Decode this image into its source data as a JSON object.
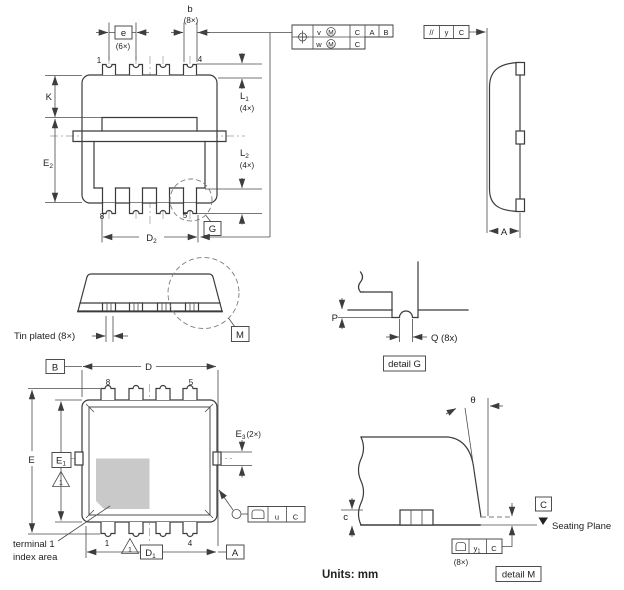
{
  "colors": {
    "line": "#3b3b3b",
    "dim": "#4a4a4a",
    "centerline": "#9a9a9a",
    "pad_shade": "#c9c9c9",
    "background": "#ffffff"
  },
  "units_label": "Units: mm",
  "top_view": {
    "dim_b": {
      "label": "b",
      "count": "(8×)"
    },
    "dim_e": {
      "label": "e",
      "count": "(6×)"
    },
    "pin_1": "1",
    "pin_4": "4",
    "pin_8": "8",
    "pin_5": "5",
    "dim_k": "K",
    "dim_e2": {
      "label": "E",
      "sub": "2"
    },
    "dim_l1": {
      "label": "L",
      "sub": "1",
      "count": "(4×)"
    },
    "dim_l2": {
      "label": "L",
      "sub": "2",
      "count": "(4×)"
    },
    "dim_d2": {
      "label": "D",
      "sub": "2"
    },
    "detail_ref_g": "G"
  },
  "tolerance_frames": {
    "position": {
      "tol_1": "v",
      "tol_2": "w",
      "modifier": "M",
      "datum_primary": "C",
      "datum_secondary": "A",
      "datum_tertiary": "B",
      "row2_datum": "C"
    },
    "parallelism": {
      "symbol": "//",
      "tolerance": "y",
      "datum": "C"
    },
    "coplanarity_u": {
      "tolerance": "u",
      "datum": "C"
    },
    "coplanarity_y1": {
      "tolerance": "y",
      "tolerance_sub": "1",
      "datum": "C",
      "count": "(8×)"
    }
  },
  "side_view": {
    "dim_a": "A"
  },
  "front_view": {
    "tin_plated_label": "Tin plated (8×)",
    "detail_ref_m": "M"
  },
  "detail_g": {
    "dim_p": "P",
    "dim_q": "Q (8x)",
    "caption": "detail G"
  },
  "bottom_view": {
    "datum_b": "B",
    "datum_a": "A",
    "dim_d": "D",
    "dim_d1": {
      "label": "D",
      "sub": "1"
    },
    "dim_e": "E",
    "dim_e1": {
      "label": "E",
      "sub": "1"
    },
    "dim_e3": {
      "label": "E",
      "sub": "3",
      "count": "(2×)"
    },
    "pin_8": "8",
    "pin_5": "5",
    "pin_1": "1",
    "pin_4": "4",
    "note_1": "1",
    "terminal_note": {
      "line1": "terminal 1",
      "line2": "index area"
    }
  },
  "detail_m": {
    "angle_theta": "θ",
    "dim_c": "c",
    "datum_c": "C",
    "seating_plane_label": "Seating Plane",
    "caption": "detail M"
  }
}
